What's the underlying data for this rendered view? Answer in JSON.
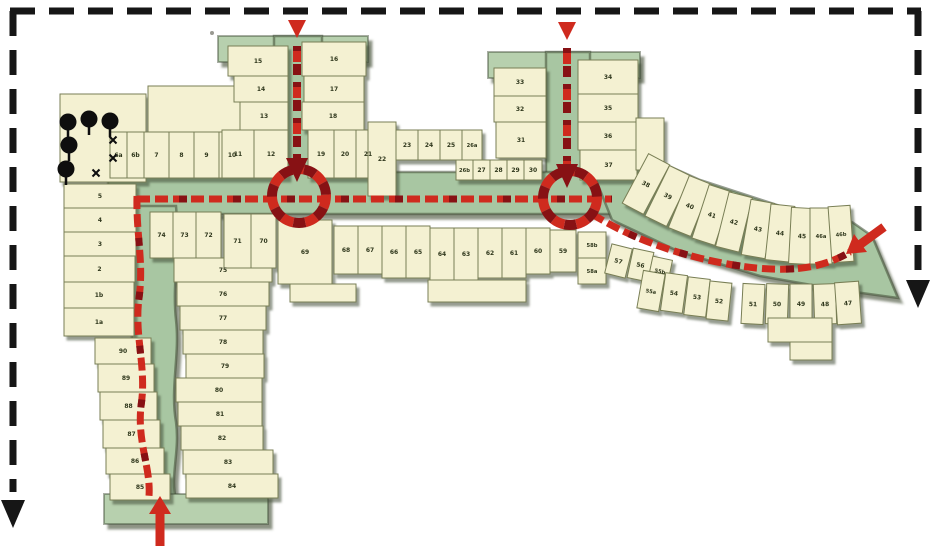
{
  "map": {
    "kind": "site-access-plan",
    "colors": {
      "plot_fill": "#f4f1d2",
      "plot_edge": "#787e54",
      "street_green": "#a8c6a2",
      "street_cap_green": "#b7d0ae",
      "shadow_olive": "#3f4c35",
      "route_red": "#cf2a1e",
      "route_dark_red": "#871114",
      "frame_black": "#161616",
      "tree_black": "#0e0e0e",
      "label_color": "#2f371c"
    },
    "entries": [
      {
        "name": "north-entry-west",
        "glyph": "arrow-down"
      },
      {
        "name": "north-entry-east",
        "glyph": "arrow-down"
      },
      {
        "name": "east-entry",
        "glyph": "arrow-into-site"
      },
      {
        "name": "south-entry",
        "glyph": "arrow-up"
      },
      {
        "name": "boundary-arrow-left",
        "glyph": "arrow-down"
      },
      {
        "name": "boundary-arrow-right",
        "glyph": "arrow-down"
      }
    ],
    "roundabouts": [
      {
        "cx": 299,
        "cy": 196,
        "r": 27
      },
      {
        "cx": 570,
        "cy": 198,
        "r": 27
      }
    ],
    "trees": [
      {
        "x": 68,
        "y": 122
      },
      {
        "x": 89,
        "y": 119
      },
      {
        "x": 110,
        "y": 121
      },
      {
        "x": 69,
        "y": 145
      },
      {
        "x": 66,
        "y": 169
      }
    ],
    "xmarks": [
      {
        "x": 113,
        "y": 140
      },
      {
        "x": 113,
        "y": 158
      },
      {
        "x": 96,
        "y": 173
      }
    ],
    "plots": [
      {
        "label": "",
        "x": 148,
        "y": 86,
        "w": 96,
        "h": 46
      },
      {
        "label": "",
        "x": 60,
        "y": 94,
        "w": 86,
        "h": 88
      },
      {
        "label": "6a",
        "x": 110,
        "y": 132,
        "w": 17,
        "h": 46
      },
      {
        "label": "6b",
        "x": 127,
        "y": 132,
        "w": 17,
        "h": 46
      },
      {
        "label": "7",
        "x": 144,
        "y": 132,
        "w": 25,
        "h": 46
      },
      {
        "label": "8",
        "x": 169,
        "y": 132,
        "w": 25,
        "h": 46
      },
      {
        "label": "9",
        "x": 194,
        "y": 132,
        "w": 25,
        "h": 46
      },
      {
        "label": "10",
        "x": 219,
        "y": 132,
        "w": 26,
        "h": 46
      },
      {
        "label": "5",
        "x": 64,
        "y": 184,
        "w": 72,
        "h": 24
      },
      {
        "label": "4",
        "x": 64,
        "y": 208,
        "w": 72,
        "h": 24
      },
      {
        "label": "3",
        "x": 64,
        "y": 232,
        "w": 72,
        "h": 24
      },
      {
        "label": "2",
        "x": 64,
        "y": 256,
        "w": 71,
        "h": 26
      },
      {
        "label": "1b",
        "x": 64,
        "y": 282,
        "w": 70,
        "h": 26
      },
      {
        "label": "1a",
        "x": 64,
        "y": 308,
        "w": 70,
        "h": 28
      },
      {
        "label": "90",
        "x": 95,
        "y": 338,
        "w": 56,
        "h": 26
      },
      {
        "label": "89",
        "x": 98,
        "y": 364,
        "w": 56,
        "h": 28
      },
      {
        "label": "88",
        "x": 100,
        "y": 392,
        "w": 57,
        "h": 28
      },
      {
        "label": "87",
        "x": 103,
        "y": 420,
        "w": 57,
        "h": 28
      },
      {
        "label": "86",
        "x": 106,
        "y": 448,
        "w": 58,
        "h": 26
      },
      {
        "label": "85",
        "x": 110,
        "y": 474,
        "w": 60,
        "h": 26
      },
      {
        "label": "75",
        "x": 174,
        "y": 258,
        "w": 98,
        "h": 24
      },
      {
        "label": "76",
        "x": 177,
        "y": 282,
        "w": 92,
        "h": 24
      },
      {
        "label": "77",
        "x": 180,
        "y": 306,
        "w": 86,
        "h": 24
      },
      {
        "label": "78",
        "x": 183,
        "y": 330,
        "w": 80,
        "h": 24
      },
      {
        "label": "79",
        "x": 186,
        "y": 354,
        "w": 78,
        "h": 24
      },
      {
        "label": "80",
        "x": 176,
        "y": 378,
        "w": 86,
        "h": 24
      },
      {
        "label": "81",
        "x": 178,
        "y": 402,
        "w": 84,
        "h": 24
      },
      {
        "label": "82",
        "x": 181,
        "y": 426,
        "w": 82,
        "h": 24
      },
      {
        "label": "83",
        "x": 183,
        "y": 450,
        "w": 90,
        "h": 24
      },
      {
        "label": "84",
        "x": 186,
        "y": 474,
        "w": 92,
        "h": 24
      },
      {
        "label": "74",
        "x": 150,
        "y": 212,
        "w": 23,
        "h": 46
      },
      {
        "label": "73",
        "x": 173,
        "y": 212,
        "w": 23,
        "h": 46
      },
      {
        "label": "72",
        "x": 196,
        "y": 212,
        "w": 25,
        "h": 46
      },
      {
        "label": "71",
        "x": 224,
        "y": 214,
        "w": 27,
        "h": 54
      },
      {
        "label": "70",
        "x": 251,
        "y": 214,
        "w": 25,
        "h": 54
      },
      {
        "label": "69",
        "x": 278,
        "y": 220,
        "w": 54,
        "h": 64
      },
      {
        "label": "68",
        "x": 334,
        "y": 226,
        "w": 24,
        "h": 48
      },
      {
        "label": "67",
        "x": 358,
        "y": 226,
        "w": 24,
        "h": 48
      },
      {
        "label": "66",
        "x": 382,
        "y": 226,
        "w": 24,
        "h": 52
      },
      {
        "label": "65",
        "x": 406,
        "y": 226,
        "w": 24,
        "h": 52
      },
      {
        "label": "64",
        "x": 430,
        "y": 228,
        "w": 24,
        "h": 52
      },
      {
        "label": "63",
        "x": 454,
        "y": 228,
        "w": 24,
        "h": 52
      },
      {
        "label": "62",
        "x": 478,
        "y": 228,
        "w": 24,
        "h": 50
      },
      {
        "label": "61",
        "x": 502,
        "y": 228,
        "w": 24,
        "h": 50
      },
      {
        "label": "60",
        "x": 526,
        "y": 228,
        "w": 24,
        "h": 46
      },
      {
        "label": "59",
        "x": 550,
        "y": 230,
        "w": 26,
        "h": 42
      },
      {
        "label": "",
        "x": 290,
        "y": 284,
        "w": 66,
        "h": 18
      },
      {
        "label": "",
        "x": 428,
        "y": 280,
        "w": 98,
        "h": 22
      },
      {
        "label": "58b",
        "x": 578,
        "y": 232,
        "w": 28,
        "h": 26
      },
      {
        "label": "58a",
        "x": 578,
        "y": 258,
        "w": 28,
        "h": 26
      },
      {
        "label": "57",
        "x": 608,
        "y": 246,
        "w": 21,
        "h": 30,
        "rot": 14
      },
      {
        "label": "56",
        "x": 630,
        "y": 250,
        "w": 21,
        "h": 30,
        "rot": 12
      },
      {
        "label": "55b",
        "x": 650,
        "y": 258,
        "w": 20,
        "h": 26,
        "rot": 12
      },
      {
        "label": "55a",
        "x": 640,
        "y": 272,
        "w": 22,
        "h": 38,
        "rot": 10
      },
      {
        "label": "54",
        "x": 663,
        "y": 274,
        "w": 22,
        "h": 38,
        "rot": 8
      },
      {
        "label": "53",
        "x": 686,
        "y": 278,
        "w": 22,
        "h": 38,
        "rot": 7
      },
      {
        "label": "52",
        "x": 708,
        "y": 282,
        "w": 22,
        "h": 38,
        "rot": 6
      },
      {
        "label": "51",
        "x": 742,
        "y": 284,
        "w": 22,
        "h": 40,
        "rot": 3
      },
      {
        "label": "50",
        "x": 766,
        "y": 284,
        "w": 22,
        "h": 40,
        "rot": 2
      },
      {
        "label": "49",
        "x": 790,
        "y": 284,
        "w": 22,
        "h": 40
      },
      {
        "label": "48",
        "x": 814,
        "y": 284,
        "w": 22,
        "h": 40,
        "rot": -2
      },
      {
        "label": "47",
        "x": 836,
        "y": 282,
        "w": 24,
        "h": 42,
        "rot": -4
      },
      {
        "label": "",
        "x": 768,
        "y": 318,
        "w": 64,
        "h": 24
      },
      {
        "label": "",
        "x": 790,
        "y": 342,
        "w": 42,
        "h": 18
      },
      {
        "label": "15",
        "x": 228,
        "y": 46,
        "w": 60,
        "h": 30
      },
      {
        "label": "14",
        "x": 234,
        "y": 76,
        "w": 54,
        "h": 26
      },
      {
        "label": "13",
        "x": 240,
        "y": 102,
        "w": 48,
        "h": 28
      },
      {
        "label": "11",
        "x": 222,
        "y": 130,
        "w": 32,
        "h": 48
      },
      {
        "label": "12",
        "x": 254,
        "y": 130,
        "w": 34,
        "h": 48
      },
      {
        "label": "16",
        "x": 302,
        "y": 42,
        "w": 64,
        "h": 34
      },
      {
        "label": "17",
        "x": 304,
        "y": 76,
        "w": 60,
        "h": 26
      },
      {
        "label": "18",
        "x": 302,
        "y": 102,
        "w": 62,
        "h": 28
      },
      {
        "label": "19",
        "x": 308,
        "y": 130,
        "w": 26,
        "h": 48
      },
      {
        "label": "20",
        "x": 334,
        "y": 130,
        "w": 22,
        "h": 48
      },
      {
        "label": "21",
        "x": 356,
        "y": 130,
        "w": 24,
        "h": 48
      },
      {
        "label": "22",
        "x": 368,
        "y": 122,
        "w": 28,
        "h": 74
      },
      {
        "label": "23",
        "x": 396,
        "y": 130,
        "w": 22,
        "h": 30
      },
      {
        "label": "24",
        "x": 418,
        "y": 130,
        "w": 22,
        "h": 30
      },
      {
        "label": "25",
        "x": 440,
        "y": 130,
        "w": 22,
        "h": 30
      },
      {
        "label": "26a",
        "x": 462,
        "y": 130,
        "w": 20,
        "h": 30
      },
      {
        "label": "26b",
        "x": 456,
        "y": 160,
        "w": 17,
        "h": 20
      },
      {
        "label": "27",
        "x": 473,
        "y": 160,
        "w": 17,
        "h": 20
      },
      {
        "label": "28",
        "x": 490,
        "y": 160,
        "w": 17,
        "h": 20
      },
      {
        "label": "29",
        "x": 507,
        "y": 160,
        "w": 17,
        "h": 20
      },
      {
        "label": "30",
        "x": 524,
        "y": 160,
        "w": 18,
        "h": 20
      },
      {
        "label": "33",
        "x": 494,
        "y": 68,
        "w": 52,
        "h": 28
      },
      {
        "label": "32",
        "x": 494,
        "y": 96,
        "w": 52,
        "h": 26
      },
      {
        "label": "31",
        "x": 496,
        "y": 122,
        "w": 50,
        "h": 36
      },
      {
        "label": "34",
        "x": 578,
        "y": 60,
        "w": 60,
        "h": 34
      },
      {
        "label": "35",
        "x": 578,
        "y": 94,
        "w": 60,
        "h": 28
      },
      {
        "label": "36",
        "x": 578,
        "y": 122,
        "w": 60,
        "h": 28
      },
      {
        "label": "37",
        "x": 580,
        "y": 150,
        "w": 57,
        "h": 30
      },
      {
        "label": "",
        "x": 636,
        "y": 118,
        "w": 28,
        "h": 52
      },
      {
        "label": "38",
        "x": 634,
        "y": 156,
        "w": 24,
        "h": 56,
        "rot": 28
      },
      {
        "label": "39",
        "x": 656,
        "y": 168,
        "w": 24,
        "h": 56,
        "rot": 26
      },
      {
        "label": "40",
        "x": 678,
        "y": 178,
        "w": 24,
        "h": 56,
        "rot": 22
      },
      {
        "label": "41",
        "x": 700,
        "y": 187,
        "w": 24,
        "h": 56,
        "rot": 18
      },
      {
        "label": "42",
        "x": 722,
        "y": 194,
        "w": 24,
        "h": 56,
        "rot": 14
      },
      {
        "label": "43",
        "x": 746,
        "y": 201,
        "w": 24,
        "h": 56,
        "rot": 10
      },
      {
        "label": "44",
        "x": 768,
        "y": 205,
        "w": 24,
        "h": 56,
        "rot": 6
      },
      {
        "label": "45",
        "x": 790,
        "y": 208,
        "w": 24,
        "h": 56,
        "rot": 3
      },
      {
        "label": "46a",
        "x": 810,
        "y": 208,
        "w": 22,
        "h": 56
      },
      {
        "label": "46b",
        "x": 830,
        "y": 206,
        "w": 22,
        "h": 56,
        "rot": -4
      }
    ]
  }
}
